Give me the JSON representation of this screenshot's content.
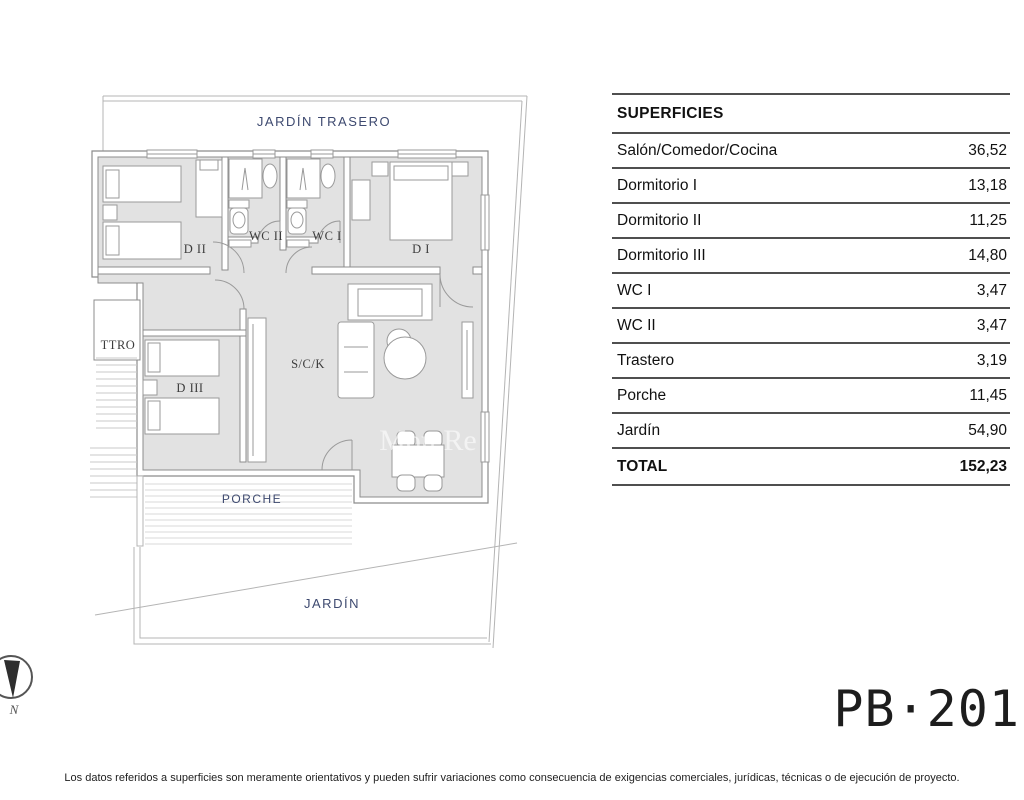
{
  "table": {
    "title": "SUPERFICIES",
    "rows": [
      {
        "label": "Salón/Comedor/Cocina",
        "value": "36,52"
      },
      {
        "label": "Dormitorio I",
        "value": "13,18"
      },
      {
        "label": "Dormitorio II",
        "value": "11,25"
      },
      {
        "label": "Dormitorio III",
        "value": "14,80"
      },
      {
        "label": "WC I",
        "value": "3,47"
      },
      {
        "label": "WC II",
        "value": "3,47"
      },
      {
        "label": "Trastero",
        "value": "3,19"
      },
      {
        "label": "Porche",
        "value": "11,45"
      },
      {
        "label": "Jardín",
        "value": "54,90"
      }
    ],
    "total": {
      "label": "TOTAL",
      "value": "152,23"
    }
  },
  "plan": {
    "rooms": {
      "jardin_trasero": "JARDÍN TRASERO",
      "dormitorio_2": "D II",
      "wc_2": "WC II",
      "wc_1": "WC I",
      "dormitorio_1": "D I",
      "trastero": "TTRO",
      "dormitorio_3": "D III",
      "salon": "S/C/K",
      "porche": "PORCHE",
      "jardin": "JARDÍN"
    },
    "compass_label": "N",
    "watermark": "Mon Re"
  },
  "plan_code": "PB·201",
  "disclaimer": "Los datos referidos a superficies son meramente orientativos y pueden sufrir variaciones como consecuencia de exigencias comerciales, jurídicas, técnicas o de ejecución de proyecto.",
  "colors": {
    "outdoor_label": "#3e4a70",
    "room_label": "#3c3c3c",
    "wall_stroke": "#8c8c8c",
    "floor_fill": "#e2e2e2",
    "table_line": "#4f4f4f"
  }
}
